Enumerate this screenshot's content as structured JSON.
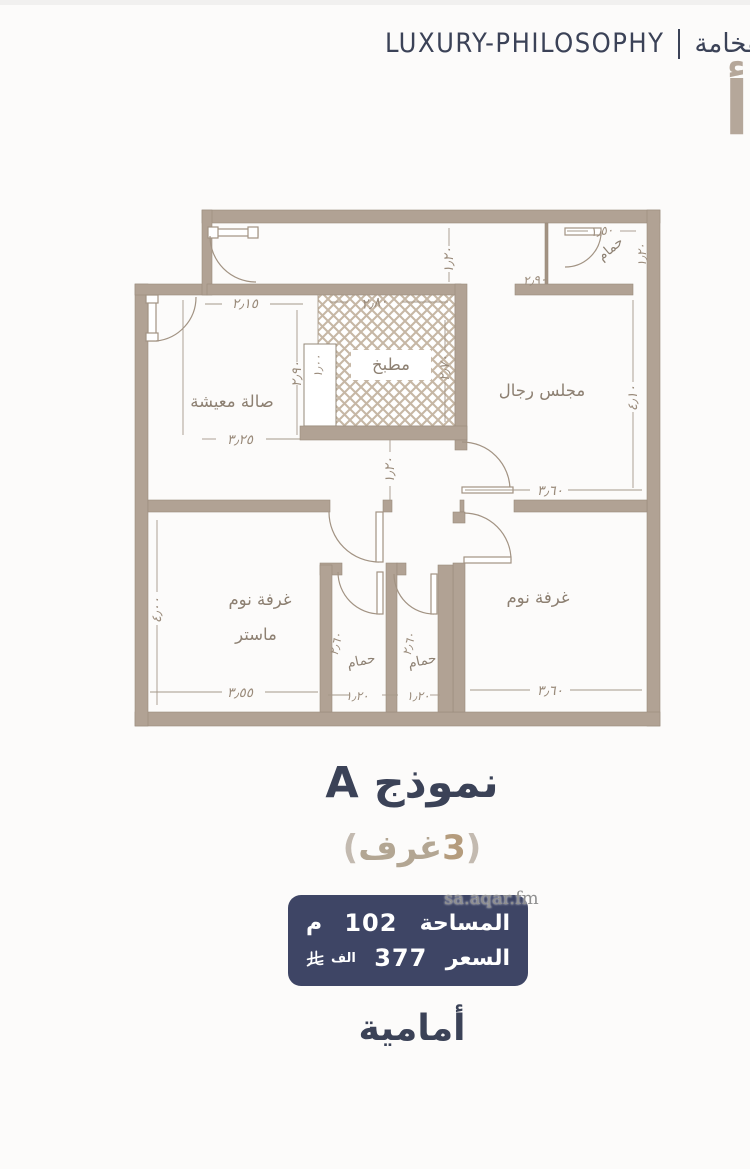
{
  "header": {
    "brand_en": "LUXURY-PHILOSOPHY",
    "divider": "|",
    "brand_ar": "قة الفخامة"
  },
  "side_letter": "أ",
  "plan": {
    "rooms": {
      "living": "صالة معيشة",
      "kitchen": "مطبخ",
      "majlis": "مجلس رجال",
      "bath_top": "حمام",
      "master_1": "غرفة نوم",
      "master_2": "ماستر",
      "bath1": "حمام",
      "bath2": "حمام",
      "bedroom": "غرفة نوم"
    },
    "dims": {
      "living_top": "٢٫١٥",
      "living_width": "٣٫٢٥",
      "living_height": "٢٫٩٠",
      "kitchen_col": "١٫٠٠",
      "kitchen_top": "٢٫٨٠",
      "kitchen_side": "٢٫٧٠",
      "strip_height": "١٫٢٠",
      "bathtop_width": "١٫٥٠",
      "bathtop_wall": "٢٫٩٠",
      "bathtop_side": "١٫٢٠",
      "majlis_width": "٣٫٦٠",
      "majlis_height": "٤٫١٠",
      "hall_width": "١٫٢٠",
      "master_width": "٣٫٥٥",
      "master_height": "٤٫٠٠",
      "bath1_width": "١٫٢٠",
      "bath1_height": "٢٫٦٠",
      "bath2_width": "١٫٢٠",
      "bath2_height": "٢٫٦٠",
      "bedroom_width": "٣٫٦٠"
    }
  },
  "model": {
    "title": "نموذج A",
    "paren_open": "(",
    "rooms_count": "3",
    "rooms_word": "غرف",
    "paren_close": ")"
  },
  "info_box": {
    "area_label": "المساحة",
    "area_value": "102",
    "area_unit": "م",
    "price_label": "السعر",
    "price_value": "377",
    "price_unit": "الف",
    "currency_icon": "saudi-riyal"
  },
  "watermark": "sa.aqar.fm",
  "orientation": "أمامية",
  "colors": {
    "navy": "#3b4257",
    "wall": "#b1a294",
    "tan": "#b59c7d",
    "box": "#3e4565"
  }
}
